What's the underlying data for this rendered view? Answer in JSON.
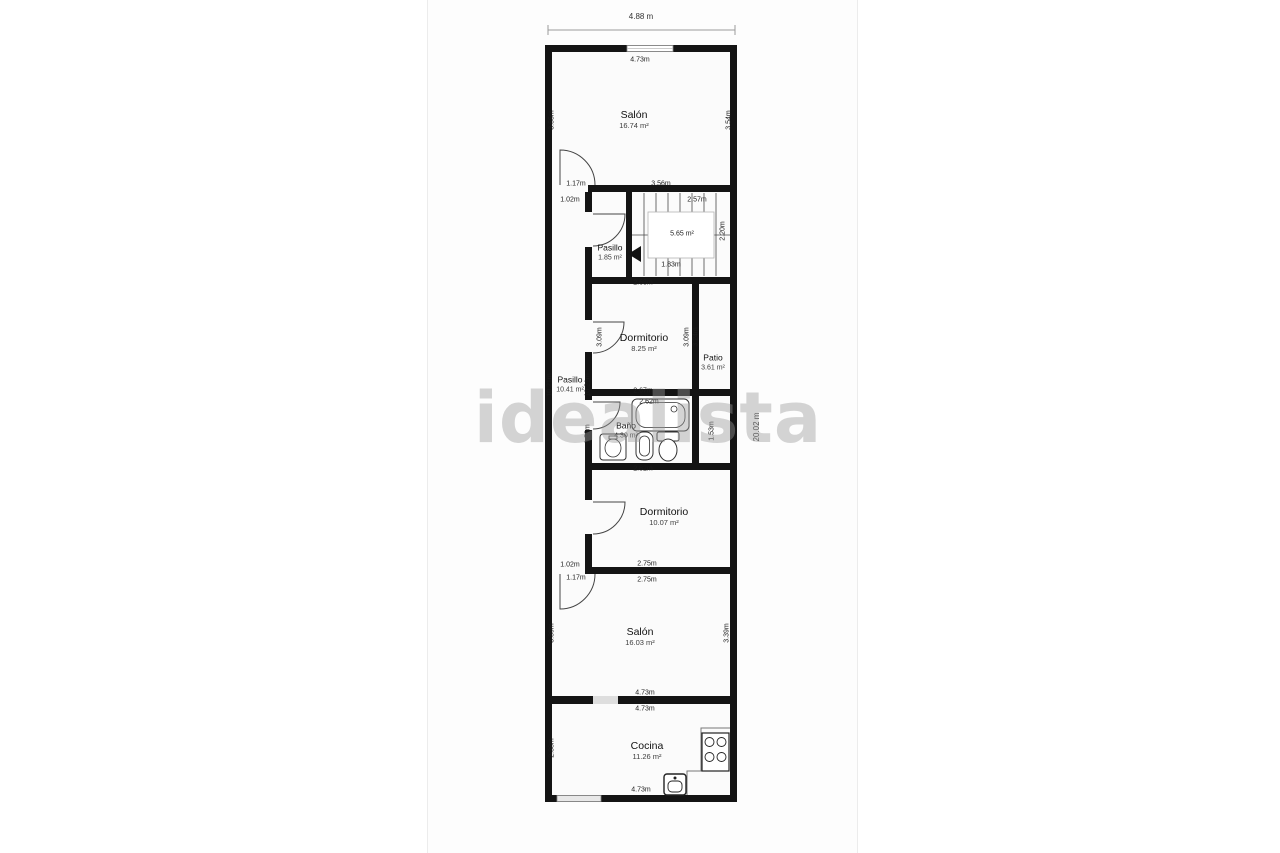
{
  "watermark": "idealista",
  "dims": {
    "overall_width": "4.88 m",
    "overall_height": "20.02 m",
    "salon1_top": "4.73m",
    "salon1_left": "3.55m",
    "salon1_right": "3.54m",
    "salon1_bottom": "3.56m",
    "salon1_door": "1.17m",
    "corridor_top": "1.02m",
    "corridor_left": "10.21m",
    "corridor_right": "10.21m",
    "corridor_bottom": "1.02m",
    "salon2_door": "1.17m",
    "stairs_top": "2.57m",
    "stairs_bottom": "1.83m",
    "stairs_right": "2.20m",
    "dorm1_top": "2.68m",
    "dorm1_bottom": "2.67m",
    "dorm1_left": "3.09m",
    "dorm1_right": "3.09m",
    "patio_left": "3.24m",
    "bano_top": "2.62m",
    "bano_left": "1.53m",
    "bano_right": "1.53m",
    "dorm2_top": "2.82m",
    "dorm2_bottom": "2.75m",
    "salon2_top": "2.75m",
    "salon2_left": "3.39m",
    "salon2_right": "3.39m",
    "salon2_bottom": "4.73m",
    "cocina_top": "4.73m",
    "cocina_left": "2.38m",
    "cocina_bottom": "4.73m"
  },
  "rooms": {
    "salon1": {
      "name": "Salón",
      "area": "16.74 m²"
    },
    "corridor": {
      "name": "Pasillo",
      "area": "10.41 m²"
    },
    "pasillo": {
      "name": "Pasillo",
      "area": "1.85 m²"
    },
    "stairs": {
      "area": "5.65 m²"
    },
    "dormitorio1": {
      "name": "Dormitorio",
      "area": "8.25 m²"
    },
    "patio": {
      "name": "Patio",
      "area": "3.61 m²"
    },
    "bano": {
      "name": "Baño",
      "area": "4.30 m²"
    },
    "dormitorio2": {
      "name": "Dormitorio",
      "area": "10.07 m²"
    },
    "salon2": {
      "name": "Salón",
      "area": "16.03 m²"
    },
    "cocina": {
      "name": "Cocina",
      "area": "11.26 m²"
    }
  },
  "icons": {
    "stairs": "stairs-icon",
    "stairs_arrow": "stairs-arrow-icon",
    "bathtub": "bathtub-icon",
    "toilet": "toilet-icon",
    "bidet": "bidet-icon",
    "washbasin": "washbasin-icon",
    "stove": "stove-icon",
    "sink": "sink-icon",
    "door": "door-arc-icon",
    "window": "window-icon"
  },
  "colors": {
    "wall": "#141414",
    "room_fill": "#fbfbfb",
    "dim_text": "#1c1c1c",
    "watermark": "#9a9a9a",
    "fixture_stroke": "#333333",
    "opening_fill": "#dedede"
  }
}
